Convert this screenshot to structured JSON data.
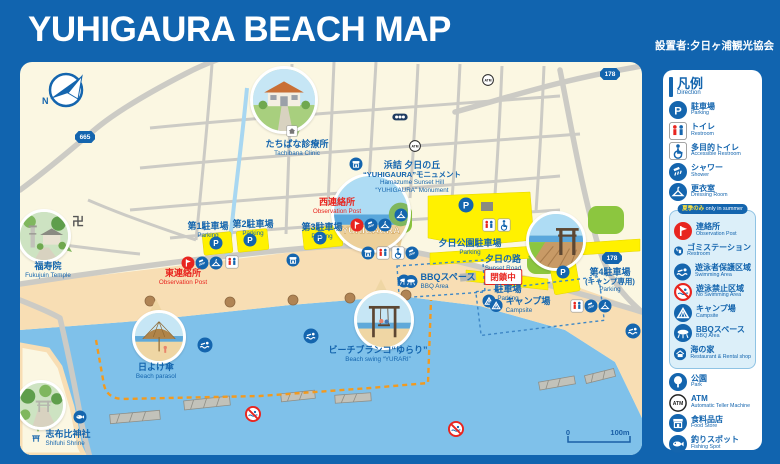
{
  "header": {
    "title": "YUHIGAURA BEACH MAP",
    "credit": "設置者:夕日ヶ浦観光協会"
  },
  "legend": {
    "title": "凡例",
    "subtitle": "Direction",
    "summer_badge_jp": "夏季のみ",
    "summer_badge_en": "only in summer",
    "items": [
      {
        "icon": "parking",
        "jp": "駐車場",
        "en": "Parking",
        "summer": false
      },
      {
        "icon": "restroom",
        "jp": "トイレ",
        "en": "Restroom",
        "summer": false
      },
      {
        "icon": "accessible",
        "jp": "多目的トイレ",
        "en": "Accessible Restroom",
        "summer": false
      },
      {
        "icon": "shower",
        "jp": "シャワー",
        "en": "Shower",
        "summer": false
      },
      {
        "icon": "dressing",
        "jp": "更衣室",
        "en": "Dressing Room",
        "summer": false
      },
      {
        "icon": "observation",
        "jp": "連絡所",
        "en": "Observation Post",
        "summer": true
      },
      {
        "icon": "trash",
        "jp": "ゴミステーション",
        "en": "Restroom",
        "summer": true
      },
      {
        "icon": "swimming",
        "jp": "遊泳者保護区域",
        "en": "Swimming Area",
        "summer": true
      },
      {
        "icon": "no-swimming",
        "jp": "遊泳禁止区域",
        "en": "No Swimming Area",
        "summer": true
      },
      {
        "icon": "camp",
        "jp": "キャンプ場",
        "en": "Campsite",
        "summer": true
      },
      {
        "icon": "bbq",
        "jp": "BBQスペース",
        "en": "BBQ Area",
        "summer": true
      },
      {
        "icon": "beach-house",
        "jp": "海の家",
        "en": "Restaurant & Rental shop",
        "summer": true
      },
      {
        "icon": "park",
        "jp": "公園",
        "en": "Park",
        "summer": false
      },
      {
        "icon": "atm",
        "jp": "ATM",
        "en": "Automatic Teller Machine",
        "summer": false
      },
      {
        "icon": "food-store",
        "jp": "食料品店",
        "en": "Food Store",
        "summer": false
      },
      {
        "icon": "fishing",
        "jp": "釣りスポット",
        "en": "Fishing Spot",
        "summer": false
      }
    ]
  },
  "map": {
    "compass_label": "N",
    "monument_bubble_text": "YUHIGAURA",
    "closed_badge": "閉鎖中",
    "scale": {
      "start": "0",
      "end": "100m"
    },
    "route_badges": [
      {
        "text": "665",
        "x": 85,
        "y": 137
      },
      {
        "text": "178",
        "x": 610,
        "y": 74
      },
      {
        "text": "178",
        "x": 612,
        "y": 258
      }
    ],
    "labels": [
      {
        "name": "tachibana-clinic",
        "jp": "たちばな診療所",
        "en": "Tachibana Clinic",
        "x": 297,
        "y": 139
      },
      {
        "name": "yuhigaura-monument",
        "jp": "浜詰 夕日の丘",
        "jp2": "“YUHIGAURA”モニュメント",
        "en": "Hamazume Sunset Hill",
        "en2": "“YUHIGAURA” Monument",
        "x": 412,
        "y": 160
      },
      {
        "name": "west-observation-post",
        "jp": "西連絡所",
        "en": "Observation Post",
        "x": 337,
        "y": 197,
        "color": "red"
      },
      {
        "name": "east-observation-post",
        "jp": "東連絡所",
        "en": "Observation Post",
        "x": 183,
        "y": 268,
        "color": "red"
      },
      {
        "name": "parking-1",
        "jp": "第1駐車場",
        "en": "Parking",
        "x": 208,
        "y": 221
      },
      {
        "name": "parking-2",
        "jp": "第2駐車場",
        "en": "Parking",
        "x": 253,
        "y": 219
      },
      {
        "name": "parking-3",
        "jp": "第3駐車場",
        "en": "Parking",
        "x": 322,
        "y": 222
      },
      {
        "name": "yuhi-park-parking",
        "jp": "夕日公園駐車場",
        "en": "Parking",
        "x": 470,
        "y": 238
      },
      {
        "name": "sunset-road",
        "jp": "夕日の路",
        "en": "Sunset Road",
        "x": 503,
        "y": 254
      },
      {
        "name": "parking-4",
        "jp": "第4駐車場",
        "jp2": "(キャンプ専用)",
        "en": "Parking",
        "x": 610,
        "y": 267
      },
      {
        "name": "closed-parking",
        "jp": "駐車場",
        "en": "Parking",
        "x": 508,
        "y": 284
      },
      {
        "name": "campsite-area",
        "jp": "キャンプ場",
        "en": "Campsite",
        "x": 520,
        "y": 296,
        "icon": "camp"
      },
      {
        "name": "bbq-area",
        "jp": "BBQスペース",
        "en": "BBQ Area",
        "x": 440,
        "y": 272,
        "icon": "bbq"
      },
      {
        "name": "beach-parasol",
        "jp": "日よけ傘",
        "en": "Beach parasol",
        "x": 156,
        "y": 362
      },
      {
        "name": "beach-swing",
        "jp": "ビーチブランコ“ゆらり”",
        "en": "Beach swing “YURARI”",
        "x": 378,
        "y": 345
      },
      {
        "name": "shifuhi-shrine",
        "jp": "志布比神社",
        "en": "Shifuhi Shrine",
        "x": 60,
        "y": 429,
        "icon": "torii"
      },
      {
        "name": "fukujuin-temple",
        "jp": "福寿院",
        "en": "Fukujuin Temple",
        "x": 48,
        "y": 261
      },
      {
        "name": "manji-temple-mark",
        "jp": "卍",
        "x": 78,
        "y": 221,
        "kind": "manji"
      }
    ],
    "icons": [
      {
        "t": "building",
        "x": 292,
        "y": 131,
        "s": 11
      },
      {
        "t": "traffic",
        "x": 400,
        "y": 117,
        "s": 17
      },
      {
        "t": "atm",
        "x": 415,
        "y": 146,
        "s": 12
      },
      {
        "t": "atm",
        "x": 488,
        "y": 80,
        "s": 12
      },
      {
        "t": "food-store",
        "x": 356,
        "y": 164,
        "s": 13
      },
      {
        "t": "food-store",
        "x": 293,
        "y": 260,
        "s": 13
      },
      {
        "t": "parking",
        "x": 216,
        "y": 243,
        "s": 13
      },
      {
        "t": "parking",
        "x": 250,
        "y": 240,
        "s": 13
      },
      {
        "t": "parking",
        "x": 320,
        "y": 238,
        "s": 13
      },
      {
        "t": "parking",
        "x": 466,
        "y": 205,
        "s": 15
      },
      {
        "t": "parking",
        "x": 563,
        "y": 272,
        "s": 13
      },
      {
        "t": "observation",
        "x": 188,
        "y": 263,
        "s": 13
      },
      {
        "t": "shower",
        "x": 202,
        "y": 263,
        "s": 13
      },
      {
        "t": "dressing",
        "x": 216,
        "y": 263,
        "s": 13
      },
      {
        "t": "restroom",
        "x": 232,
        "y": 262,
        "s": 13
      },
      {
        "t": "observation",
        "x": 357,
        "y": 225,
        "s": 13
      },
      {
        "t": "shower",
        "x": 371,
        "y": 225,
        "s": 13
      },
      {
        "t": "dressing",
        "x": 385,
        "y": 225,
        "s": 13
      },
      {
        "t": "dressing",
        "x": 401,
        "y": 215,
        "s": 13
      },
      {
        "t": "food-store",
        "x": 368,
        "y": 253,
        "s": 13
      },
      {
        "t": "restroom",
        "x": 383,
        "y": 253,
        "s": 13
      },
      {
        "t": "accessible",
        "x": 398,
        "y": 253,
        "s": 13
      },
      {
        "t": "shower",
        "x": 412,
        "y": 253,
        "s": 13
      },
      {
        "t": "restroom",
        "x": 489,
        "y": 225,
        "s": 13
      },
      {
        "t": "accessible",
        "x": 504,
        "y": 225,
        "s": 13
      },
      {
        "t": "restroom",
        "x": 577,
        "y": 306,
        "s": 13
      },
      {
        "t": "shower",
        "x": 591,
        "y": 306,
        "s": 13
      },
      {
        "t": "dressing",
        "x": 605,
        "y": 306,
        "s": 13
      },
      {
        "t": "camp",
        "x": 489,
        "y": 301,
        "s": 13
      },
      {
        "t": "bbq",
        "x": 404,
        "y": 281,
        "s": 13
      },
      {
        "t": "swimming",
        "x": 205,
        "y": 345,
        "s": 15
      },
      {
        "t": "swimming",
        "x": 311,
        "y": 336,
        "s": 15
      },
      {
        "t": "swimming",
        "x": 633,
        "y": 331,
        "s": 15
      },
      {
        "t": "no-swimming",
        "x": 253,
        "y": 414,
        "s": 16
      },
      {
        "t": "no-swimming",
        "x": 456,
        "y": 429,
        "s": 16
      },
      {
        "t": "fishing",
        "x": 80,
        "y": 417,
        "s": 13
      }
    ]
  }
}
